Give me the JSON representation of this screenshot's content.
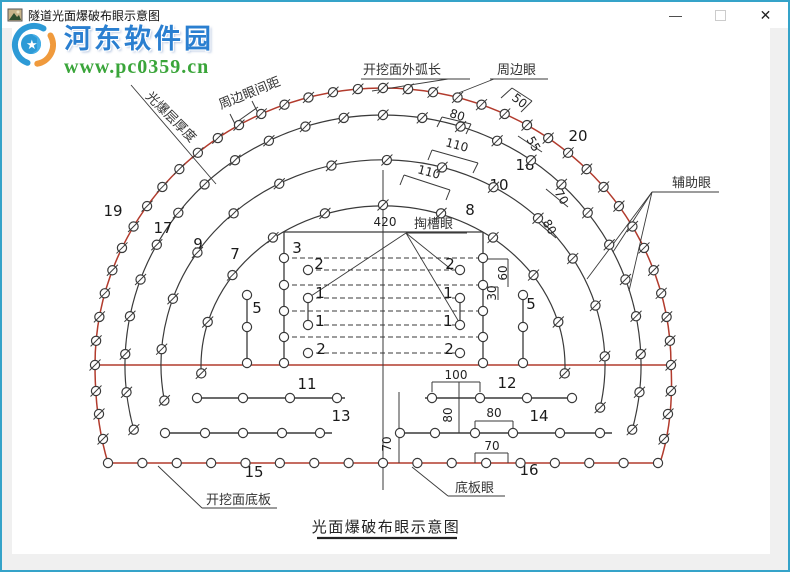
{
  "window": {
    "title": "隧道光面爆破布眼示意图",
    "buttons": {
      "minimize": "—",
      "maximize": "",
      "close": "✕"
    },
    "border_color": "#35a3c9",
    "titlebar_bg": "#ffffff",
    "client_bg": "#f0f0f0",
    "canvas_bg": "#ffffff"
  },
  "watermark": {
    "site_name": "河东软件园",
    "site_url": "www.pc0359.cn",
    "name_color": "#2a7fd0",
    "url_color": "#3aa53a",
    "logo_blue": "#2d9ad6",
    "logo_orange": "#f09a3c"
  },
  "diagram": {
    "caption": {
      "t": "光面爆破布眼示意图",
      "x": 386,
      "y": 532,
      "ul": [
        317,
        457,
        538
      ]
    },
    "colors": {
      "red": "#b23b2d",
      "ink": "#3a3a3a"
    },
    "cx": 383,
    "cy": 365,
    "rings": [
      {
        "rx": 288,
        "ry": 277,
        "a0": 180,
        "a1": 0,
        "n": 37,
        "red": true
      },
      {
        "rx": 258,
        "ry": 250,
        "a0": 195,
        "a1": -15,
        "n": 25
      },
      {
        "rx": 222,
        "ry": 205,
        "a0": 190,
        "a1": -12,
        "n": 15
      },
      {
        "rx": 182,
        "ry": 160,
        "a0": 183,
        "a1": -3,
        "n": 11
      }
    ],
    "walls": [
      {
        "d": "M 95 365 Q 95 420 108 463",
        "holes": [
          [
            96,
            391
          ],
          [
            99,
            414
          ],
          [
            103,
            439
          ]
        ]
      },
      {
        "d": "M 671 365 Q 674 420 660 463",
        "holes": [
          [
            671,
            391
          ],
          [
            668,
            414
          ],
          [
            664,
            439
          ]
        ]
      }
    ],
    "red_lines": [
      [
        95,
        365,
        671,
        365
      ],
      [
        108,
        463,
        660,
        463
      ]
    ],
    "bottom_holes": {
      "x1": 108,
      "x2": 658,
      "y": 463,
      "n": 17
    },
    "rect": {
      "x1": 284,
      "x2": 483,
      "y1": 232,
      "y2": 363,
      "edge_holes_y": [
        258,
        285,
        311,
        337,
        363
      ],
      "inner_x": [
        308,
        460
      ],
      "inner_holes_y": [
        270,
        298,
        325,
        353
      ],
      "tick_y": [
        298,
        325
      ]
    },
    "cols": [
      {
        "x": 247,
        "y1": 295,
        "y2": 363,
        "holes": [
          295,
          327,
          363
        ]
      },
      {
        "x": 523,
        "y1": 295,
        "y2": 363,
        "holes": [
          295,
          327,
          363
        ]
      }
    ],
    "rows": [
      {
        "y": 398,
        "x1": 197,
        "x2": 345,
        "holes": [
          197,
          243,
          290,
          337
        ]
      },
      {
        "y": 398,
        "x1": 425,
        "x2": 575,
        "holes": [
          432,
          480,
          527,
          572
        ]
      },
      {
        "y": 433,
        "x1": 163,
        "x2": 332,
        "holes": [
          165,
          205,
          243,
          282,
          320
        ]
      },
      {
        "y": 433,
        "x1": 398,
        "x2": 612,
        "holes": [
          400,
          435,
          475,
          513,
          560,
          600
        ]
      }
    ],
    "ink_lines": [
      [
        383,
        170,
        383,
        490
      ],
      [
        459,
        382,
        459,
        433
      ],
      [
        399,
        392,
        399,
        463
      ],
      [
        483,
        259,
        508,
        259
      ],
      [
        508,
        259,
        508,
        287
      ],
      [
        483,
        287,
        498,
        287
      ],
      [
        498,
        287,
        498,
        300
      ],
      [
        432,
        392,
        432,
        382
      ],
      [
        480,
        392,
        480,
        382
      ],
      [
        432,
        382,
        480,
        382
      ],
      [
        475,
        433,
        475,
        421
      ],
      [
        475,
        421,
        513,
        421
      ],
      [
        513,
        433,
        513,
        421
      ],
      [
        475,
        463,
        475,
        453
      ],
      [
        475,
        453,
        508,
        453
      ],
      [
        508,
        463,
        508,
        453
      ],
      [
        501,
        98,
        512,
        88
      ],
      [
        512,
        88,
        532,
        101
      ],
      [
        532,
        101,
        521,
        112
      ],
      [
        437,
        127,
        442,
        117
      ],
      [
        442,
        117,
        471,
        124
      ],
      [
        471,
        124,
        466,
        134
      ],
      [
        428,
        160,
        432,
        150
      ],
      [
        432,
        150,
        478,
        163
      ],
      [
        478,
        163,
        473,
        173
      ],
      [
        400,
        185,
        404,
        175
      ],
      [
        404,
        175,
        450,
        190
      ],
      [
        450,
        190,
        446,
        200
      ],
      [
        518,
        136,
        542,
        152
      ],
      [
        546,
        189,
        568,
        207
      ],
      [
        534,
        219,
        556,
        238
      ],
      [
        234,
        124,
        258,
        107
      ],
      [
        230,
        114,
        238,
        130
      ],
      [
        252,
        101,
        260,
        117
      ]
    ],
    "dash_rows": {
      "full": {
        "x1": 284,
        "x2": 483,
        "ys": [
          258,
          285,
          311,
          337
        ]
      },
      "inner": {
        "x1": 308,
        "x2": 460,
        "ys": [
          270,
          298,
          325,
          353
        ]
      }
    },
    "numbers": [
      [
        "19",
        113,
        216
      ],
      [
        "17",
        163,
        233
      ],
      [
        "9",
        198,
        249
      ],
      [
        "7",
        235,
        259
      ],
      [
        "20",
        578,
        141
      ],
      [
        "18",
        525,
        170
      ],
      [
        "10",
        499,
        190
      ],
      [
        "8",
        470,
        215
      ],
      [
        "5",
        257,
        313
      ],
      [
        "5",
        531,
        309
      ],
      [
        "3",
        297,
        253
      ],
      [
        "2",
        319,
        269
      ],
      [
        "1",
        320,
        298
      ],
      [
        "1",
        320,
        326
      ],
      [
        "2",
        321,
        354
      ],
      [
        "2",
        450,
        269
      ],
      [
        "1",
        448,
        298
      ],
      [
        "1",
        448,
        326
      ],
      [
        "2",
        449,
        354
      ],
      [
        "11",
        307,
        389
      ],
      [
        "12",
        507,
        388
      ],
      [
        "13",
        341,
        421
      ],
      [
        "14",
        539,
        421
      ],
      [
        "15",
        254,
        477
      ],
      [
        "16",
        529,
        475
      ]
    ],
    "dims": [
      [
        "420",
        385,
        226,
        0
      ],
      [
        "50",
        517,
        104,
        38
      ],
      [
        "80",
        456,
        119,
        18
      ],
      [
        "110",
        456,
        149,
        15
      ],
      [
        "110",
        428,
        176,
        15
      ],
      [
        "55",
        530,
        146,
        60
      ],
      [
        "70",
        558,
        199,
        60
      ],
      [
        "80",
        546,
        229,
        60
      ],
      [
        "60",
        507,
        273,
        -90
      ],
      [
        "30",
        496,
        293,
        -90
      ],
      [
        "100",
        456,
        379,
        0
      ],
      [
        "80",
        452,
        415,
        -90
      ],
      [
        "80",
        494,
        417,
        0
      ],
      [
        "70",
        492,
        450,
        0
      ],
      [
        "70",
        391,
        444,
        -90
      ]
    ],
    "labels": [
      {
        "t": "开挖面外弧长",
        "x": 363,
        "y": 74,
        "ul": [
          361,
          470,
          79
        ],
        "leads": [
          [
            448,
            79,
            372,
            91
          ]
        ]
      },
      {
        "t": "周边眼",
        "x": 497,
        "y": 74,
        "ul": [
          490,
          548,
          79
        ],
        "leads": [
          [
            494,
            79,
            456,
            94
          ]
        ]
      },
      {
        "t": "辅助眼",
        "x": 672,
        "y": 187,
        "ul": [
          652,
          719,
          192
        ],
        "leads": [
          [
            652,
            192,
            587,
            279
          ],
          [
            652,
            192,
            613,
            252
          ],
          [
            652,
            192,
            629,
            291
          ]
        ]
      },
      {
        "t": "掏槽眼",
        "x": 414,
        "y": 228,
        "ul": [
          406,
          467,
          233
        ],
        "leads": [
          [
            406,
            233,
            311,
            296
          ],
          [
            406,
            233,
            452,
            270
          ],
          [
            406,
            233,
            459,
            322
          ]
        ]
      },
      {
        "t": "开挖面底板",
        "x": 206,
        "y": 504,
        "ul": [
          202,
          277,
          508
        ],
        "leads": [
          [
            202,
            508,
            158,
            466
          ]
        ]
      },
      {
        "t": "底板眼",
        "x": 455,
        "y": 492,
        "ul": [
          448,
          505,
          496
        ],
        "leads": [
          [
            448,
            496,
            412,
            467
          ]
        ]
      },
      {
        "t": "周边眼间距",
        "x": 251,
        "y": 97,
        "rot": -22
      },
      {
        "t": "光爆层厚度",
        "x": 168,
        "y": 120,
        "rot": 45,
        "leads": [
          [
            131,
            85,
            216,
            184
          ]
        ]
      }
    ]
  }
}
